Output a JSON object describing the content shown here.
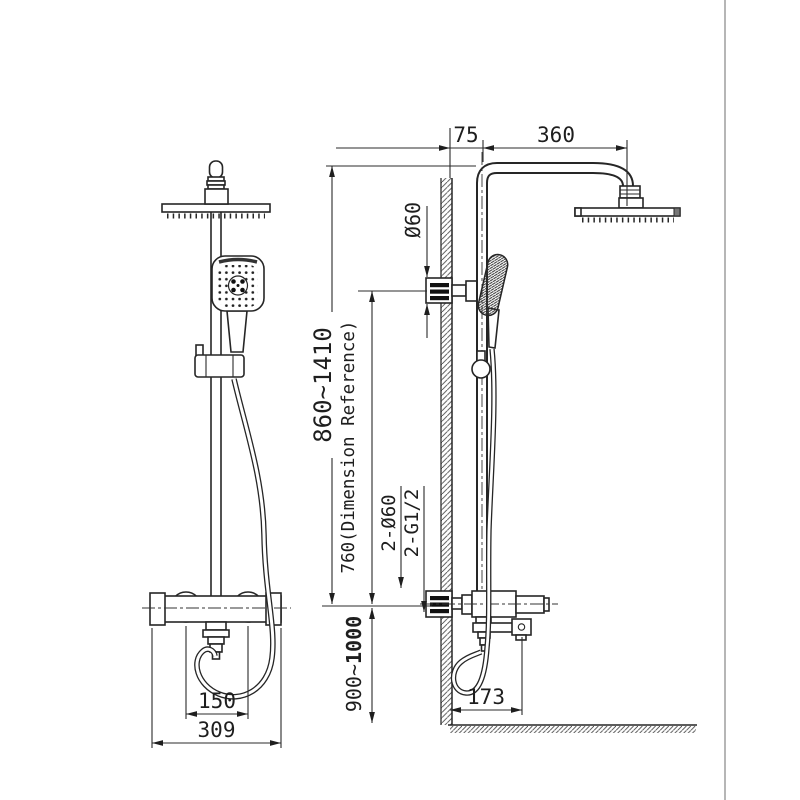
{
  "drawing": {
    "dimensions": {
      "wall_offset": "75",
      "arm_reach": "360",
      "mount_diameter": "Ø60",
      "overall_height_range": "860~1410",
      "reference_height": "760(Dimension Reference)",
      "inlet_diameter": "2-Ø60",
      "inlet_thread": "2-G1/2",
      "install_height_prefix": "900~",
      "install_height_bold": "1000",
      "spout_reach": "173",
      "handle_spacing": "150",
      "valve_width": "309"
    },
    "colors": {
      "line": "#262626",
      "dimension_line": "#2b2b2b",
      "frame": "#9e9e9e",
      "background": "#ffffff"
    }
  }
}
